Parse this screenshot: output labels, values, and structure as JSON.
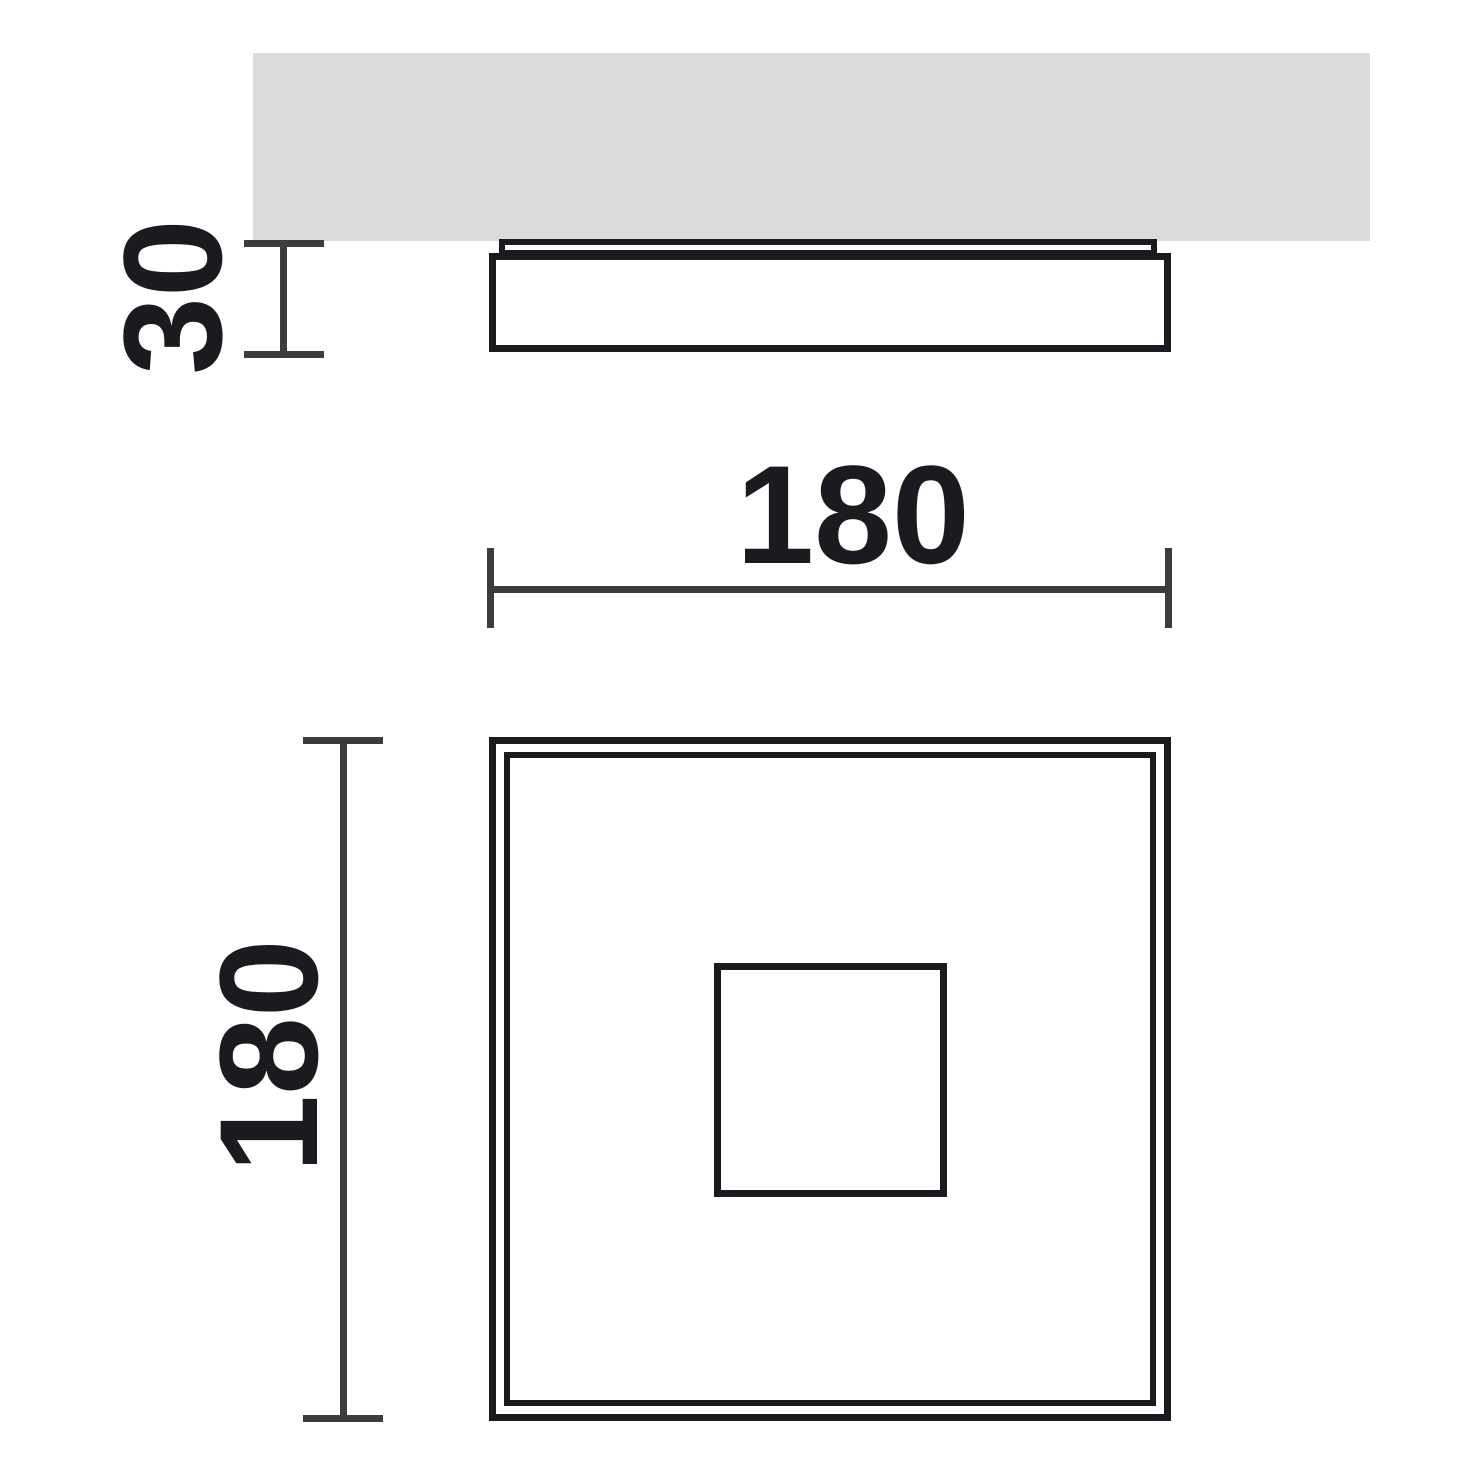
{
  "drawing": {
    "type": "technical-dimension-drawing",
    "colors": {
      "background": "#ffffff",
      "outline": "#1b1b1f",
      "dimension_line": "#3c3c3e",
      "ceiling_fill": "#dcdcde",
      "label_text": "#1b1b1f"
    },
    "dimensions": {
      "height": {
        "label": "30"
      },
      "width": {
        "label": "180"
      },
      "depth": {
        "label": "180"
      }
    }
  }
}
